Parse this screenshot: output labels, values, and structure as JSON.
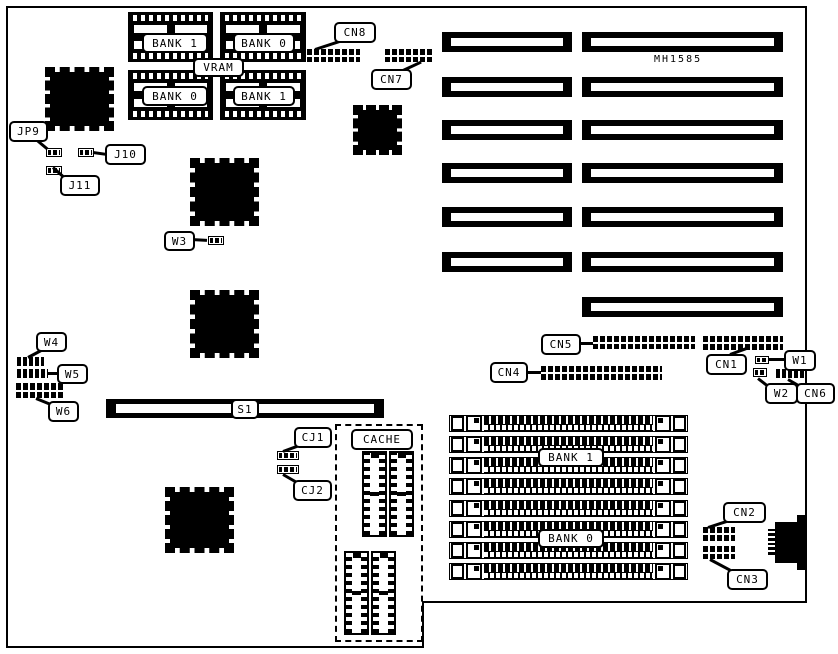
{
  "diagram": {
    "part_number": "MH1585",
    "vram": {
      "title": "VRAM",
      "bank_top_left": "BANK 1",
      "bank_top_right": "BANK 0",
      "bank_bottom_left": "BANK 0",
      "bank_bottom_right": "BANK 1"
    },
    "memory": {
      "bank1": "BANK 1",
      "bank0": "BANK 0"
    },
    "cache_title": "CACHE",
    "slot_s1": "S1",
    "connectors": {
      "cn1": "CN1",
      "cn2": "CN2",
      "cn3": "CN3",
      "cn4": "CN4",
      "cn5": "CN5",
      "cn6": "CN6",
      "cn7": "CN7",
      "cn8": "CN8"
    },
    "jumpers": {
      "jp9": "JP9",
      "j10": "J10",
      "j11": "J11",
      "w1": "W1",
      "w2": "W2",
      "w3": "W3",
      "w4": "W4",
      "w5": "W5",
      "w6": "W6",
      "cj1": "CJ1",
      "cj2": "CJ2"
    },
    "colors": {
      "ink": "#000000",
      "paper": "#ffffff"
    }
  }
}
